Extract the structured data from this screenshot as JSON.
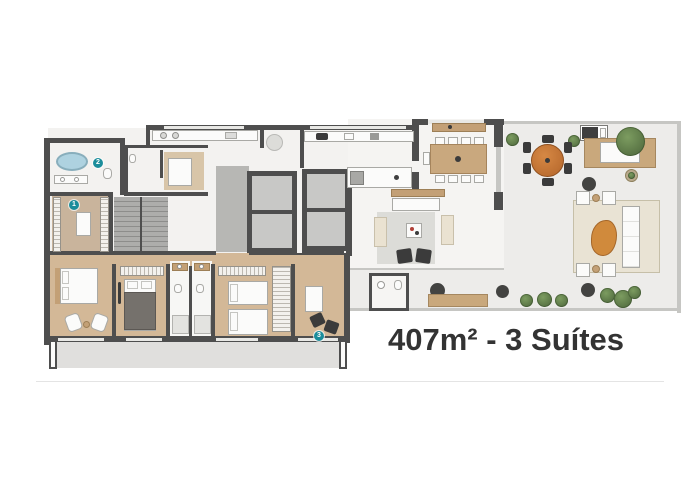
{
  "title": {
    "text": "407m² - 3 Suítes"
  },
  "markers": [
    {
      "n": "1",
      "name": "marker-closet"
    },
    {
      "n": "2",
      "name": "marker-master-bath"
    },
    {
      "n": "3",
      "name": "marker-office-suite"
    }
  ],
  "palette": {
    "wall": "#4e4e4e",
    "floor_light": "#f4f3f1",
    "floor_terrace": "#edecea",
    "wood": "#d3b897",
    "accent_teal": "#1b8d9b",
    "orange": "#cd7c3c",
    "plant_green": "#5d7a49",
    "bathtub_blue": "#aed2e0",
    "title_text": "#333333",
    "divider": "#e4e4e4"
  }
}
